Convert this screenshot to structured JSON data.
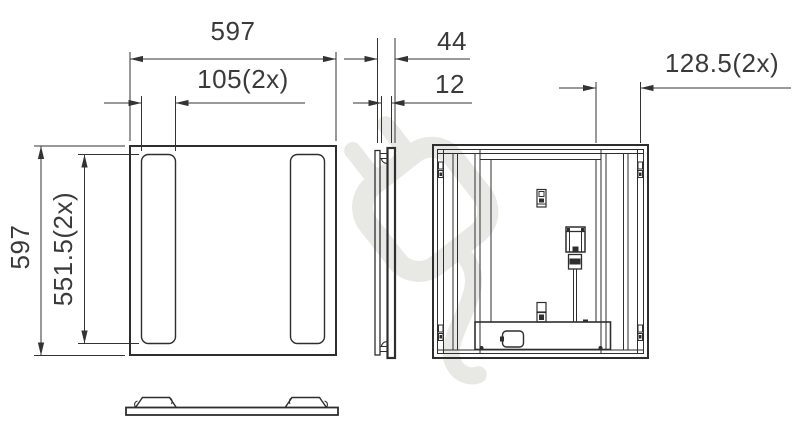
{
  "dimensions": {
    "front_width": "597",
    "slot_width": "105(2x)",
    "front_height": "597",
    "slot_height": "551.5(2x)",
    "depth": "44",
    "recess_depth": "12",
    "mount_offset": "128.5(2x)"
  },
  "colors": {
    "line": "#2e2e2e",
    "dim_line": "#333333",
    "text": "#3a3a3a",
    "watermark": "#e8e8e5",
    "background": "#ffffff"
  },
  "icons": {
    "watermark": "plug-watermark-icon"
  }
}
